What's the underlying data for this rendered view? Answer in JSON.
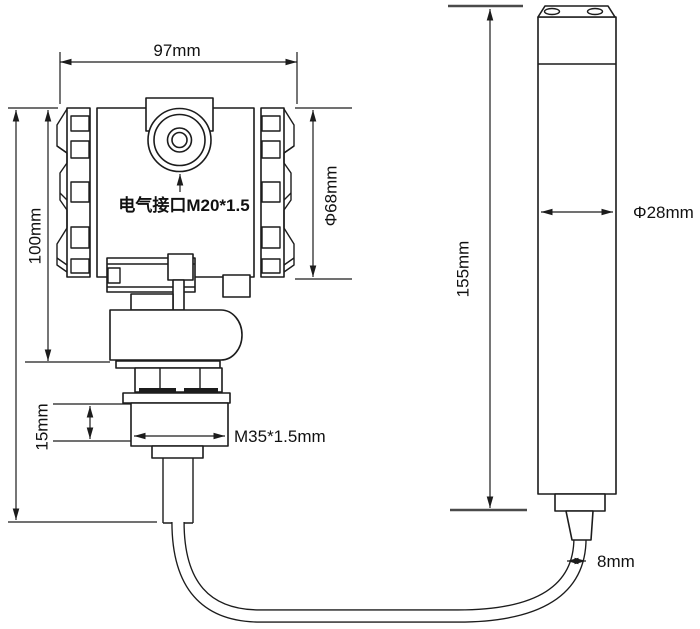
{
  "drawing": {
    "transmitter": {
      "overall_width": "97mm",
      "housing_height": "100mm",
      "housing_diameter": "Φ68mm",
      "electrical_port_label": "电气接口M20*1.5",
      "thread_section_height": "15mm",
      "process_thread": "M35*1.5mm"
    },
    "probe": {
      "length": "155mm",
      "diameter": "Φ28mm"
    },
    "cable": {
      "diameter": "8mm"
    },
    "colors": {
      "line": "#1c1c1c",
      "background": "#ffffff"
    }
  }
}
